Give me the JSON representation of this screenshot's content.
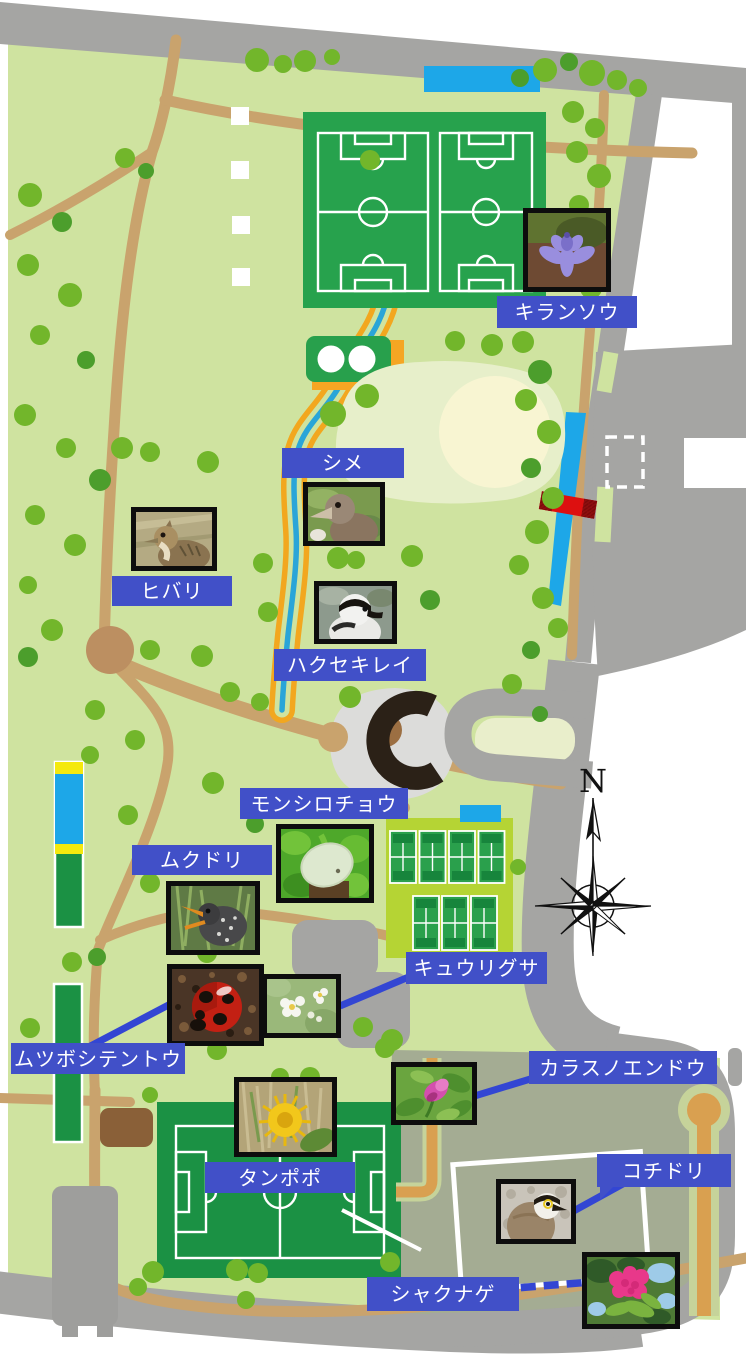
{
  "compass": {
    "north_label": "N"
  },
  "markers": [
    {
      "id": "kiransou",
      "label": "キランソウ",
      "subject": "purple-flower-photo"
    },
    {
      "id": "shime",
      "label": "シメ",
      "subject": "hawfinch-bird-photo"
    },
    {
      "id": "hibari",
      "label": "ヒバリ",
      "subject": "skylark-bird-photo"
    },
    {
      "id": "hakusekirei",
      "label": "ハクセキレイ",
      "subject": "wagtail-bird-photo"
    },
    {
      "id": "monshirochou",
      "label": "モンシロチョウ",
      "subject": "white-butterfly-photo"
    },
    {
      "id": "mukudori",
      "label": "ムクドリ",
      "subject": "starling-bird-photo"
    },
    {
      "id": "mutsuboshitentou",
      "label": "ムツボシテントウ",
      "subject": "ladybird-beetle-photo"
    },
    {
      "id": "kyuurigusa",
      "label": "キュウリグサ",
      "subject": "small-white-flower-photo"
    },
    {
      "id": "karasunoendou",
      "label": "カラスノエンドウ",
      "subject": "pink-vetch-flower-photo"
    },
    {
      "id": "tanpopo",
      "label": "タンポポ",
      "subject": "dandelion-photo"
    },
    {
      "id": "kochidori",
      "label": "コチドリ",
      "subject": "plover-bird-photo"
    },
    {
      "id": "shakunage",
      "label": "シャクナゲ",
      "subject": "rhododendron-photo"
    }
  ],
  "colors": {
    "label_bg": "#4150c8",
    "connector_blue": "#3346d3",
    "park_green": "#cfe3a0",
    "tree_green": "#72b62b",
    "tree_green_dark": "#4c9e2c",
    "road_gray": "#a5a5a3",
    "path_tan": "#c9a36d",
    "stream_blue": "#2aa5d8",
    "stream_path_orange": "#f2a71f",
    "sports_field_green": "#23a04d",
    "tennis_bg": "#b5d434",
    "water_blue": "#1da7e8",
    "sage_area": "#a4ac93",
    "bridge_red": "#dd1010",
    "photo_frame": "#0d0d0d"
  }
}
